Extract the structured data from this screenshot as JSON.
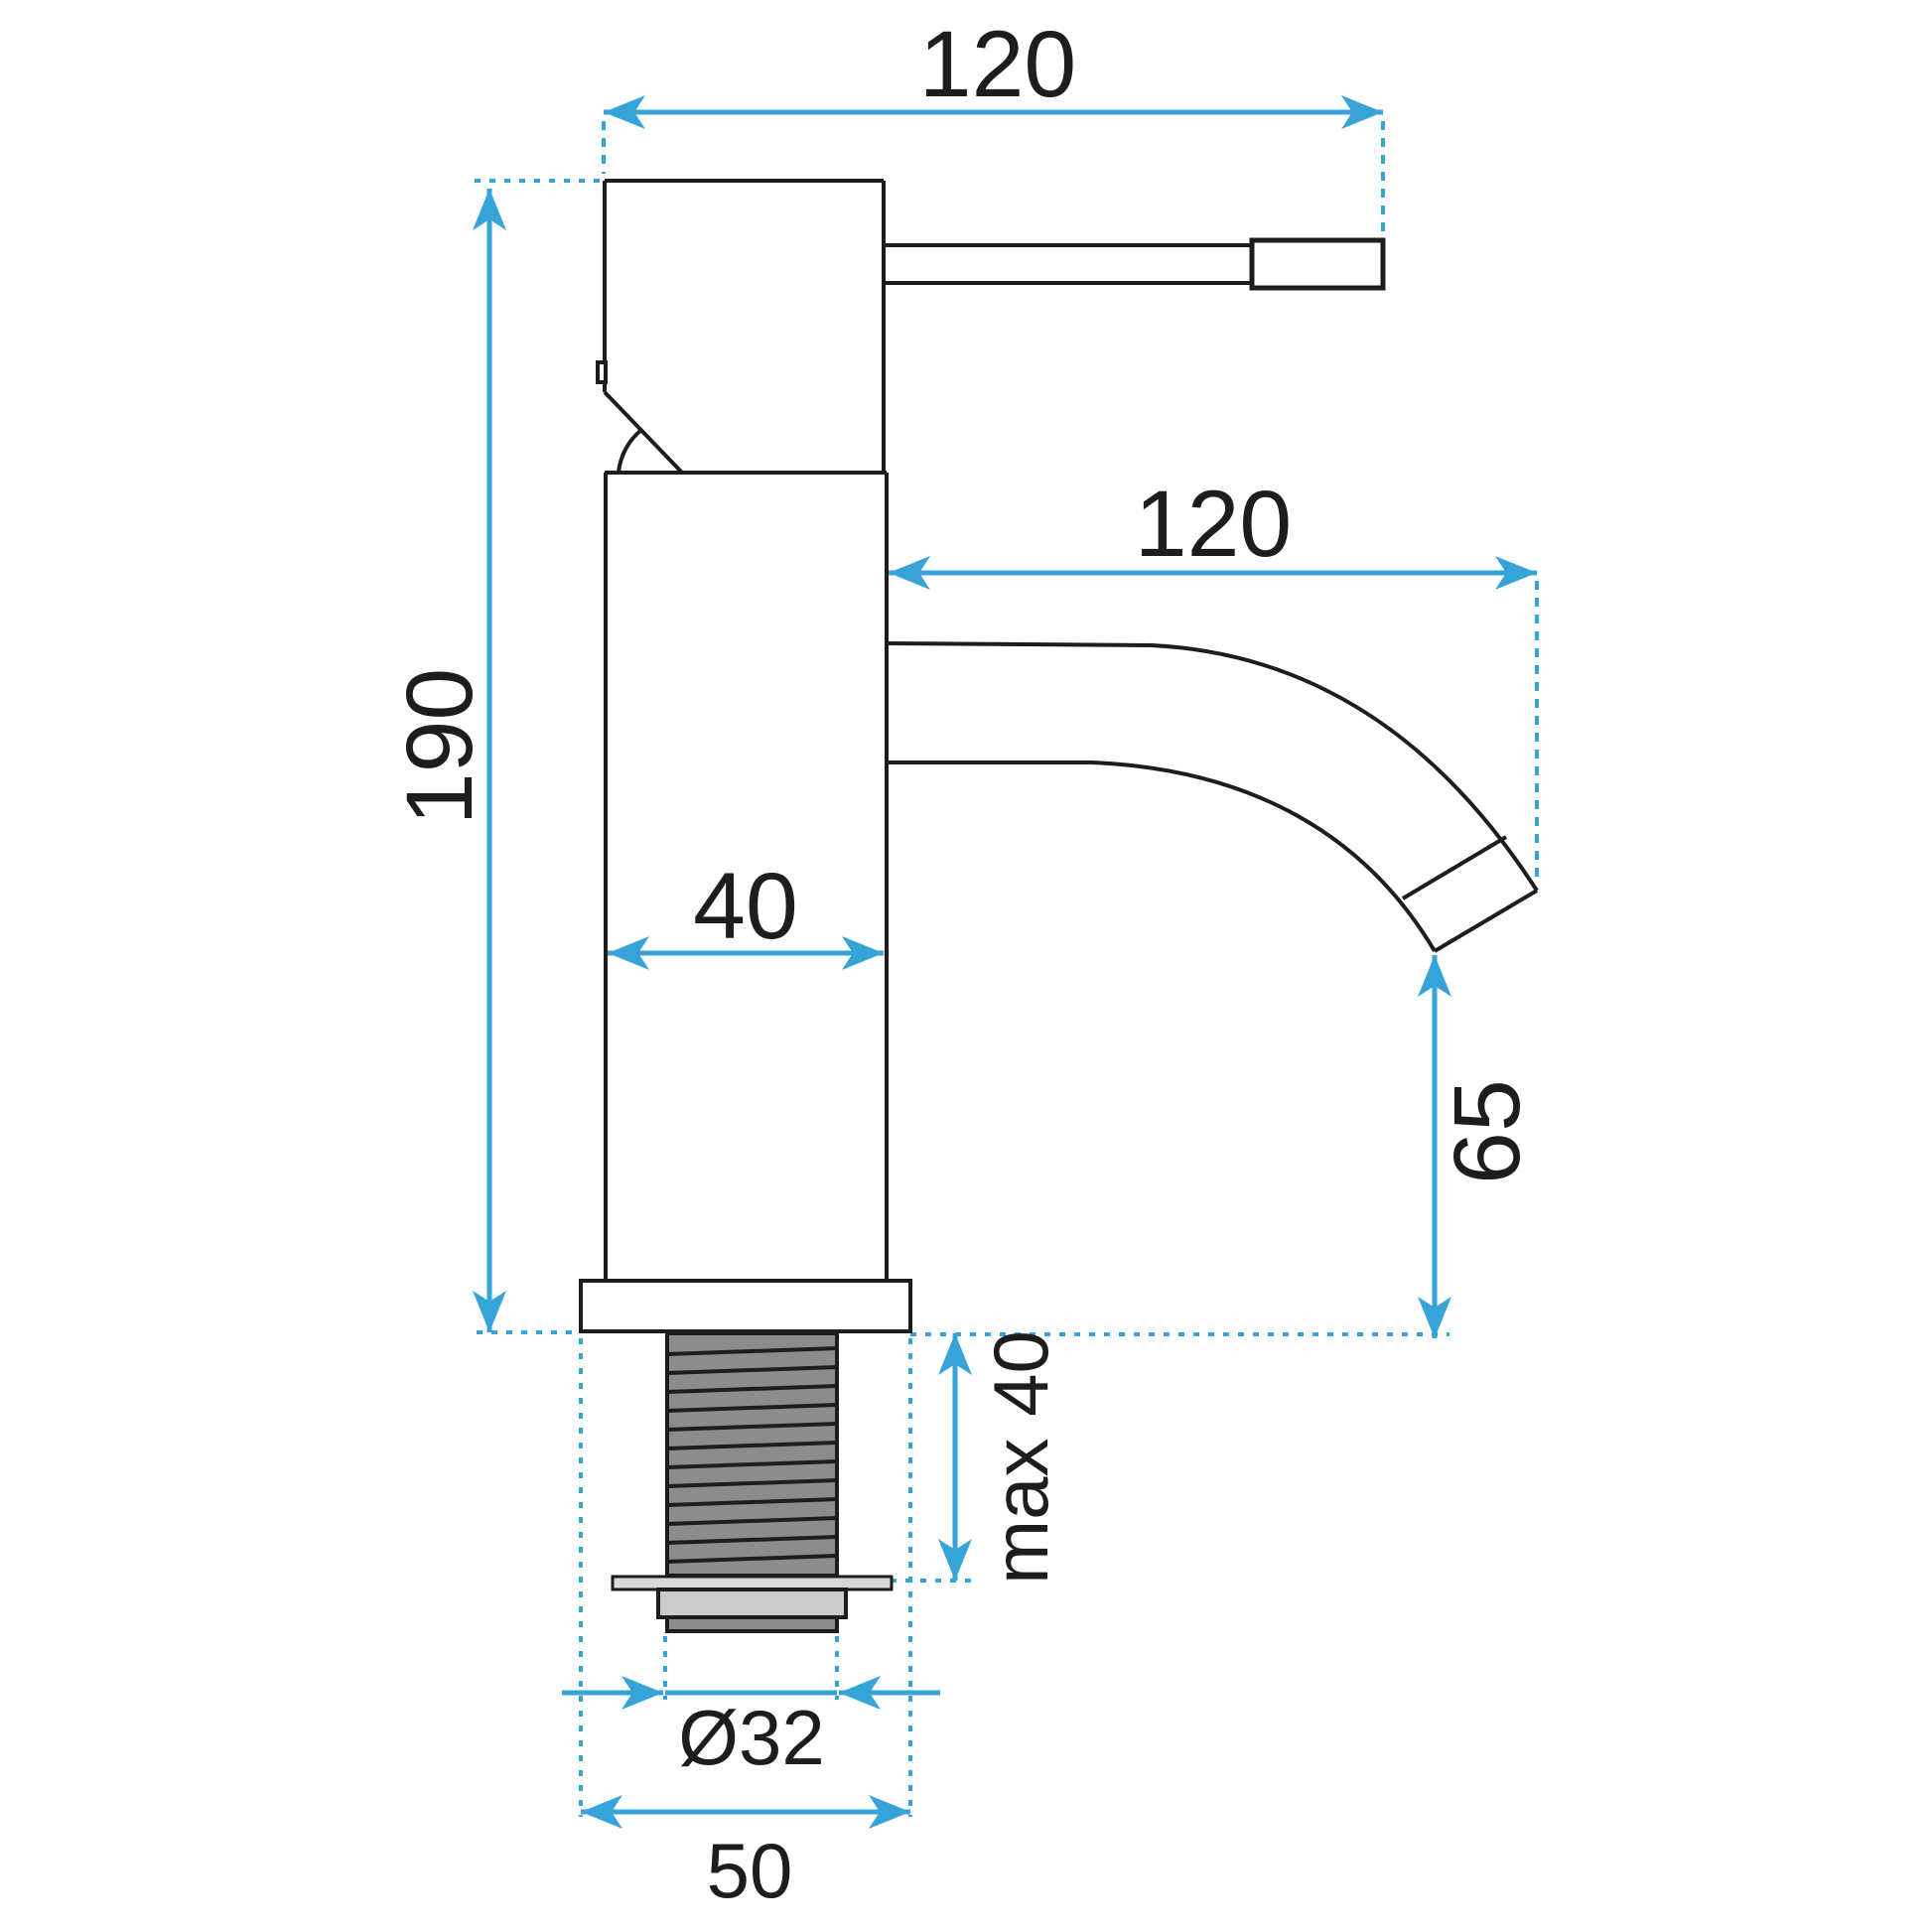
{
  "colors": {
    "background": "#ffffff",
    "line": "#1d1d1b",
    "accent": "#36a3d9",
    "thread_fill": "#8c8c8c",
    "nut_fill": "#cbcbcb",
    "flange_fill": "#d9d9d9"
  },
  "dimensions": {
    "handle_reach": "120",
    "spout_reach": "120",
    "total_height": "190",
    "body_width": "40",
    "spout_outlet_height": "65",
    "max_mounting_depth": "max 40",
    "shank_thread_diameter": "Ø32",
    "base_width": "50"
  }
}
